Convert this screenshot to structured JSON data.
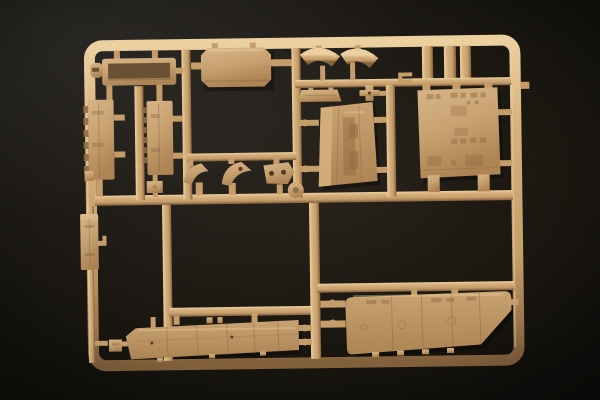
{
  "scene": {
    "type": "photograph",
    "subject": "tan injection-molded plastic model kit sprue on a black backdrop",
    "visible_text": "",
    "colors": {
      "background": "#0a0908",
      "plastic_base": "#c59d6a",
      "plastic_highlight": "#ecd0a0",
      "plastic_shadow": "#82603c",
      "panel_face": "#c8a271",
      "recess": "#6b5134"
    }
  },
  "sprue": {
    "frame_shape": "rounded-rectangle runner frame with internal cross runners",
    "orientation_tilt_deg": -0.8,
    "part_count": 21,
    "parts": [
      {
        "id": "tray-box",
        "label": "open tray box with clip tab (top left)"
      },
      {
        "id": "hull-side-left",
        "label": "vertical panel with hinge bumps (left cell, left)"
      },
      {
        "id": "hull-side-right",
        "label": "vertical panel with hinge bumps (left cell, right)"
      },
      {
        "id": "stowage-box",
        "label": "beveled rectangular box (top center)"
      },
      {
        "id": "fender-left",
        "label": "curved fender band (top center-right)"
      },
      {
        "id": "fender-right",
        "label": "curved fender band (top center-right)"
      },
      {
        "id": "nose-plate",
        "label": "trapezoid nose plate"
      },
      {
        "id": "cross-part",
        "label": "small cross-shaped fitting"
      },
      {
        "id": "small-clip",
        "label": "tiny two-prong clip"
      },
      {
        "id": "glacis-plate",
        "label": "sloped hatched plate (center)"
      },
      {
        "id": "rear-panel",
        "label": "large detailed rear panel (top right)"
      },
      {
        "id": "bracket-a",
        "label": "small curved bracket"
      },
      {
        "id": "bracket-b",
        "label": "curved bracket with hole"
      },
      {
        "id": "bracket-plate",
        "label": "plate bracket with two holes"
      },
      {
        "id": "disc",
        "label": "small disc on center junction"
      },
      {
        "id": "mast-bracket",
        "label": "narrow vertical bracket (lower left)"
      },
      {
        "id": "small-square-block",
        "label": "small square block"
      },
      {
        "id": "small-block",
        "label": "small rectangular block"
      },
      {
        "id": "parallelogram-plate",
        "label": "small parallelogram plate"
      },
      {
        "id": "track-guard",
        "label": "long paneled strip (bottom center)"
      },
      {
        "id": "side-skirt",
        "label": "large side skirt with angled rear (bottom right)"
      }
    ]
  }
}
